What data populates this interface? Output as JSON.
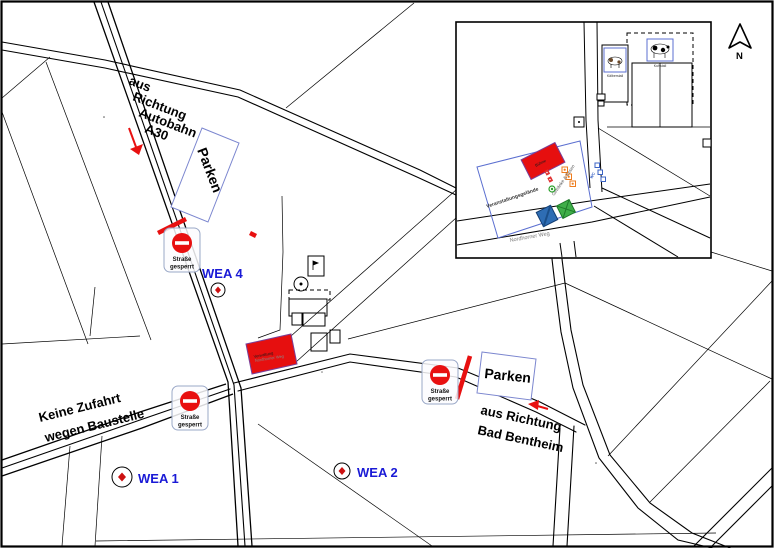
{
  "map": {
    "direction_labels": {
      "a30": {
        "lines": [
          "aus",
          "Richtung",
          "Autobahn",
          "A30"
        ]
      },
      "bad_bentheim": {
        "lines": [
          "aus Richtung",
          "Bad Bentheim"
        ]
      },
      "construction": {
        "lines": [
          "Keine Zufahrt",
          "wegen Baustelle"
        ]
      }
    },
    "parking_label": "Parken",
    "road_closed": {
      "lines": [
        "Straße",
        "gesperrt"
      ]
    },
    "turbines": [
      {
        "label": "WEA 1"
      },
      {
        "label": "WEA 2"
      },
      {
        "label": "WEA 4"
      }
    ],
    "street_label": "Nordhorner Weg",
    "admin_building_label": "Verwaltung",
    "north_label": "N",
    "colors": {
      "closure_red": "#e81010",
      "turbine_label_blue": "#1a1ad6",
      "parking_border_blue": "#7b86cf",
      "building_highlight_red": "#e60f0f",
      "building_highlight_border": "#7a3f98"
    }
  },
  "inset": {
    "area_label": "Veranstaltungsgelände",
    "street_label": "Nordhorner Weg",
    "food_label": "Getränke & Essen",
    "wc_label": "WC",
    "stage_label": "Bühne",
    "cow_barn_label": "Kuhstall",
    "calf_barn_label": "Kälberstall",
    "colors": {
      "event_area_blue": "#5b6fd0",
      "stage_red": "#e60f0f",
      "food_orange": "#ee7d1f",
      "wc_blue": "#3b63c4",
      "symbol_blue": "#2e6db4",
      "symbol_green": "#3fae49"
    }
  }
}
